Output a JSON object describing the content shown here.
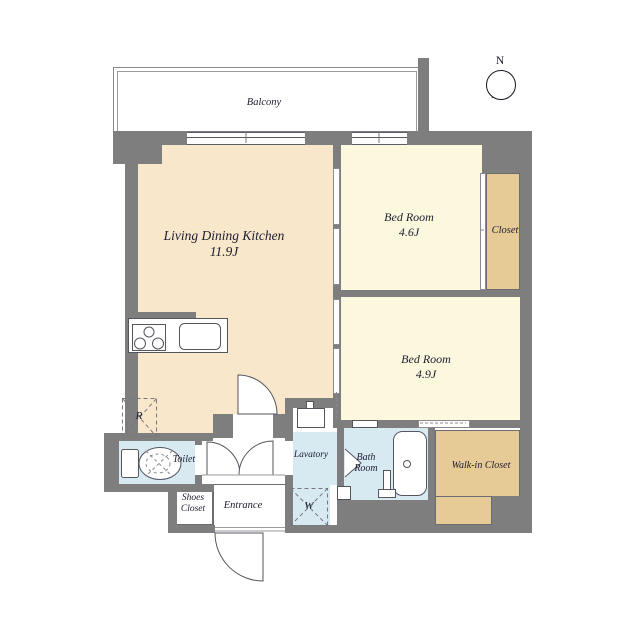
{
  "title": "Apartment floor plan",
  "compass": {
    "north_label": "N"
  },
  "rooms": {
    "balcony": {
      "label": "Balcony"
    },
    "ldk": {
      "name": "Living Dining Kitchen",
      "size": "11.9J"
    },
    "bedroom_1": {
      "name": "Bed Room",
      "size": "4.6J"
    },
    "closet": {
      "name": "Closet"
    },
    "bedroom_2": {
      "name": "Bed Room",
      "size": "4.9J"
    },
    "walk_in_closet": {
      "name": "Walk-in Closet"
    },
    "bath": {
      "line1": "Bath",
      "line2": "Room"
    },
    "lavatory": {
      "name": "Lavatory"
    },
    "toilet": {
      "name": "Toilet"
    },
    "shoes_closet": {
      "line1": "Shoes",
      "line2": "Closet"
    },
    "entrance": {
      "name": "Entrance"
    }
  },
  "fixtures": {
    "refrigerator_symbol": "R",
    "washer_symbol": "W"
  },
  "colors": {
    "wall": "#7e7e7e",
    "ldk": "#f8e7ca",
    "bed": "#fbf8de",
    "tan": "#e7cb97",
    "wet": "#d7eaf2",
    "ink": "#1c1c30"
  }
}
